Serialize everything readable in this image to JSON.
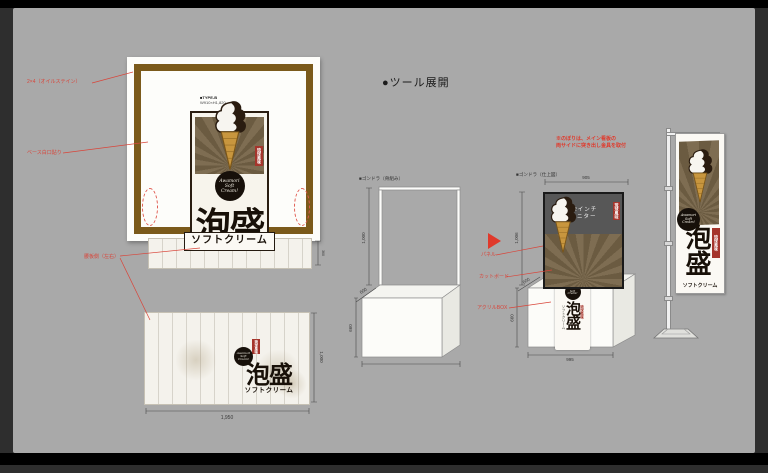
{
  "heading": {
    "label": "●ツール展開"
  },
  "sign": {
    "type_label": "■TYPE-B",
    "size_label": "W910×H1,820",
    "seal_text": "琉球風味",
    "badge": {
      "line1": "Awamori",
      "line2": "Soft",
      "line3": "Cream!"
    },
    "title": "泡盛",
    "subtitle": "ソフトクリーム"
  },
  "annotations": {
    "lumber": "2×4（オイルステイン）",
    "base": "ベース白口貼り",
    "side_panel": "腰板側（左右）",
    "panel": "パネル",
    "cut_board": "カットボード",
    "acrylic": "アクリルBOX",
    "nobori_line1": "※のぼりは、メイン看板の",
    "nobori_line2": "両サイドに突き出し金具を取付"
  },
  "side_strip": {
    "dim": "360"
  },
  "back_panel": {
    "dim_width": "1,950",
    "dim_height": "1,000"
  },
  "frame_counter": {
    "label": "■ゴンドラ（骨組み）",
    "dim_height": "1,000",
    "dim_depth": "600",
    "dim_counter_height": "660"
  },
  "finished_counter": {
    "label": "■ゴンドラ（仕上図）",
    "monitor_line1": "42インチ",
    "monitor_line2": "モニター",
    "dim_top": "905",
    "dim_height": "1,006",
    "dim_depth": "600",
    "dim_counter_height": "660",
    "dim_bottom": "995"
  },
  "colors": {
    "frame_brown": "#7b5a1b",
    "seal_red": "#a5352c",
    "annotation_red": "#d9453a",
    "cone_tan": "#c8963e",
    "canvas_gray": "#a9a9a9"
  }
}
